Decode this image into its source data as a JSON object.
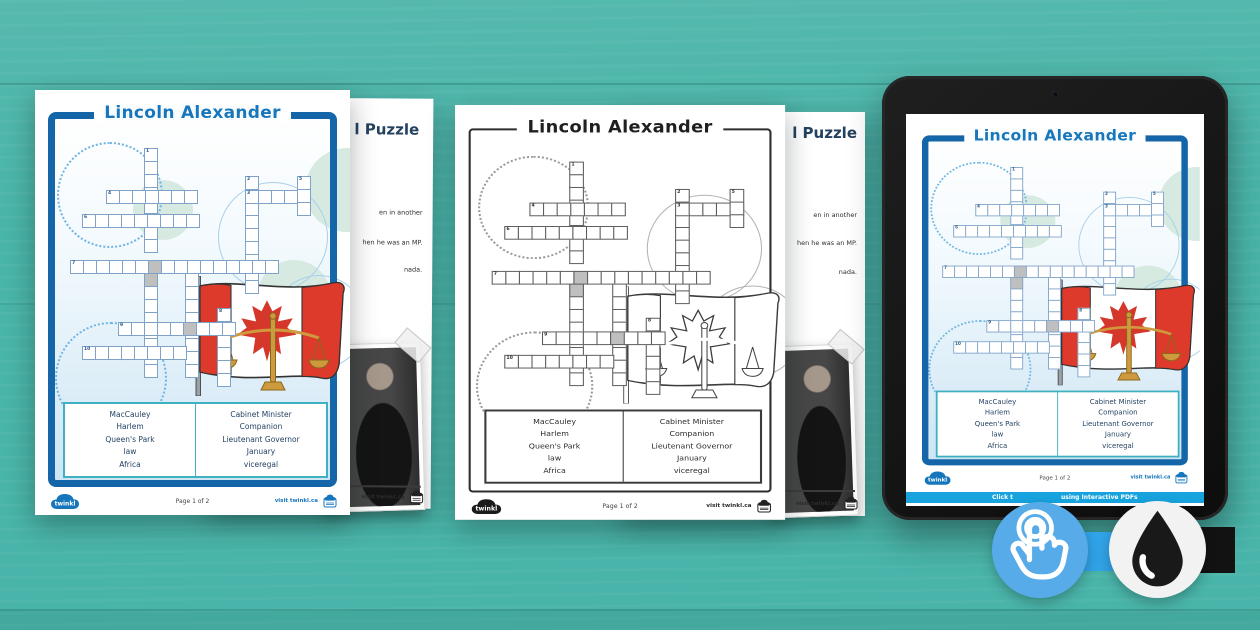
{
  "scene": {
    "background_color": "#49b4a9",
    "accent_blue": "#1877bb",
    "frame_blue": "#1565a9",
    "banner_blue": "#17a3de",
    "flag_red": "#d93a2c",
    "tap_badge_blue": "#58abe9",
    "ink_badge_black": "#191919"
  },
  "worksheet": {
    "title": "Lincoln Alexander",
    "word_bank": {
      "left_column": [
        "MacCauley",
        "Harlem",
        "Queen's Park",
        "law",
        "Africa"
      ],
      "right_column": [
        "Cabinet Minister",
        "Companion",
        "Lieutenant Governor",
        "January",
        "viceregal"
      ]
    },
    "footer": {
      "brand": "twinkl",
      "page_label": "Page 1 of 2",
      "visit_label": "visit twinkl.ca"
    },
    "crossword": {
      "cell_size": 14,
      "runs": [
        {
          "num": "1",
          "dir": "v",
          "x": 84,
          "y": 0,
          "cells": 8
        },
        {
          "num": "4",
          "dir": "h",
          "x": 46,
          "y": 42,
          "cells": 7
        },
        {
          "num": "6",
          "dir": "h",
          "x": 22,
          "y": 66,
          "cells": 9
        },
        {
          "num": "2",
          "dir": "v",
          "x": 185,
          "y": 28,
          "cells": 9
        },
        {
          "num": "3",
          "dir": "h",
          "x": 185,
          "y": 42,
          "cells": 5
        },
        {
          "num": "5",
          "dir": "v",
          "x": 237,
          "y": 28,
          "cells": 3
        },
        {
          "num": "7",
          "dir": "h",
          "x": 10,
          "y": 112,
          "cells": 16,
          "gray": [
            6
          ]
        },
        {
          "num": "",
          "dir": "v",
          "x": 84,
          "y": 125,
          "cells": 8,
          "gray": [
            0
          ]
        },
        {
          "num": "",
          "dir": "v",
          "x": 125,
          "y": 125,
          "cells": 8
        },
        {
          "num": "8",
          "dir": "v",
          "x": 157,
          "y": 160,
          "cells": 6,
          "gray": [
            1
          ]
        },
        {
          "num": "9",
          "dir": "h",
          "x": 58,
          "y": 174,
          "cells": 9,
          "gray": [
            5
          ]
        },
        {
          "num": "10",
          "dir": "h",
          "x": 22,
          "y": 198,
          "cells": 8
        }
      ]
    }
  },
  "page_two": {
    "title_fragment": "l Puzzle",
    "clue_fragments": [
      "en in another",
      "hen he was an MP.",
      "nada."
    ]
  },
  "tablet": {
    "banner_fragment_left": "Click t",
    "banner_fragment_right": "using Interactive PDFs"
  },
  "icons": {
    "tap": "tap-finger-icon",
    "ink_drop": "ink-drop-icon",
    "camera": "camera-dot-icon",
    "logo": "twinkl-cloud-logo"
  }
}
